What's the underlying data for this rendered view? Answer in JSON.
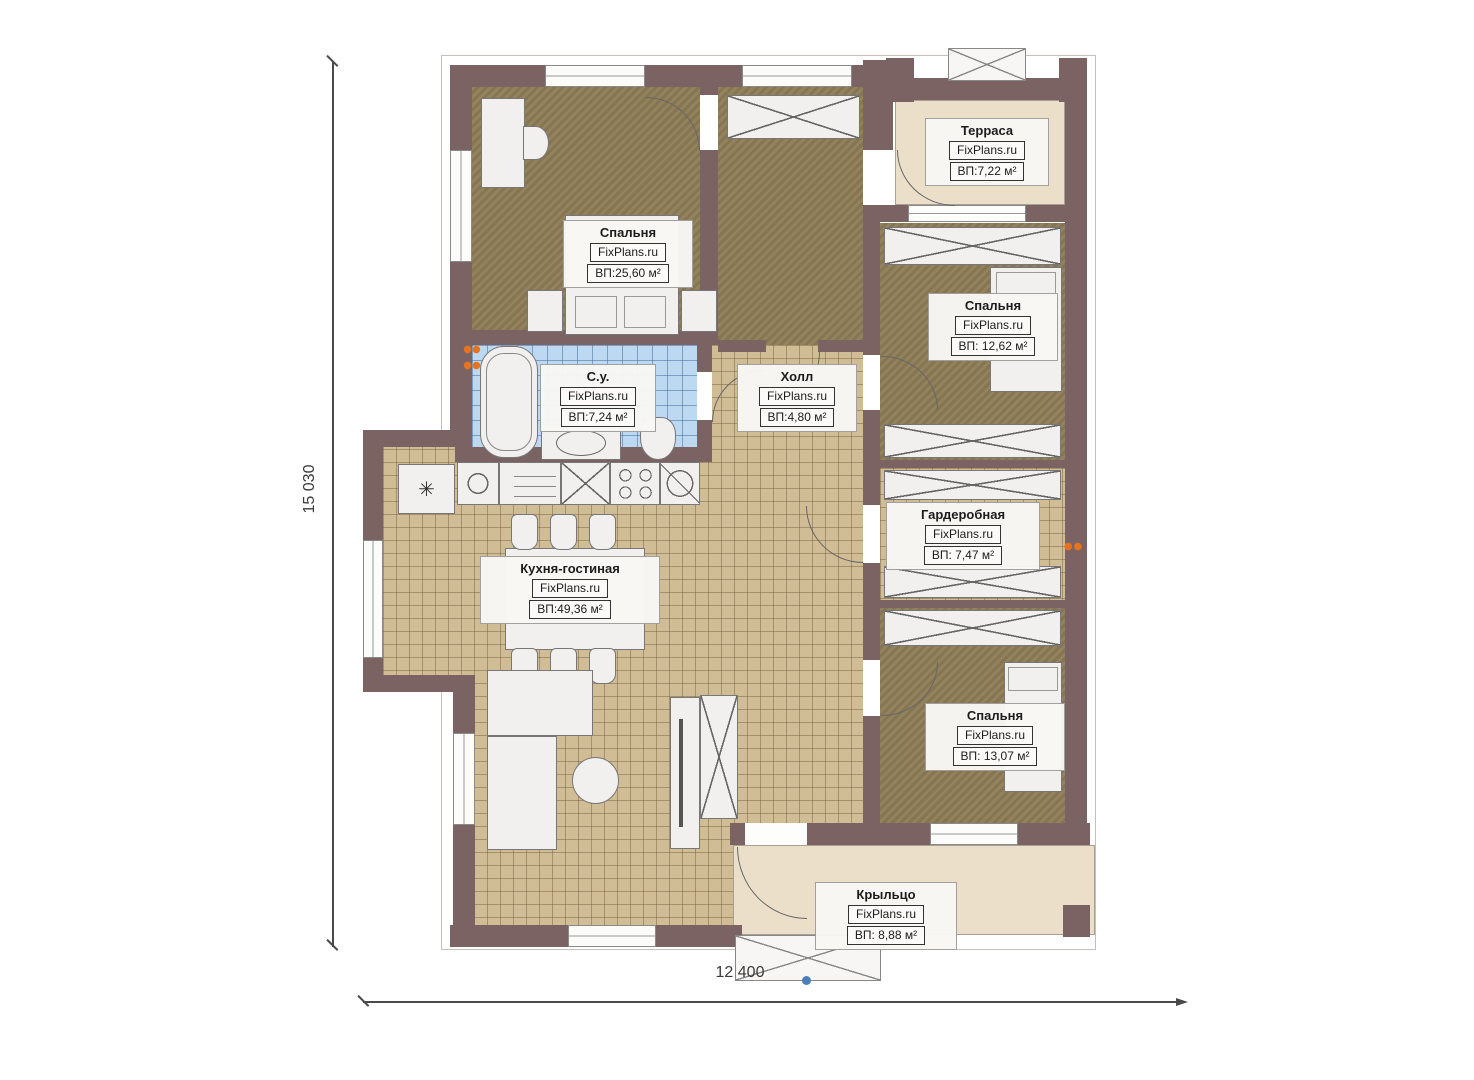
{
  "plan": {
    "brand": "FixPlans.ru",
    "dimensions": {
      "height_label": "15 030",
      "width_label": "12 400"
    },
    "rooms": [
      {
        "key": "bedroom-1",
        "name": "Спальня",
        "brand": "FixPlans.ru",
        "area": "ВП:25,60 м²"
      },
      {
        "key": "terrace",
        "name": "Терраса",
        "brand": "FixPlans.ru",
        "area": "ВП:7,22 м²"
      },
      {
        "key": "bedroom-2",
        "name": "Спальня",
        "brand": "FixPlans.ru",
        "area": "ВП: 12,62 м²"
      },
      {
        "key": "bathroom",
        "name": "С.у.",
        "brand": "FixPlans.ru",
        "area": "ВП:7,24 м²"
      },
      {
        "key": "hall",
        "name": "Холл",
        "brand": "FixPlans.ru",
        "area": "ВП:4,80 м²"
      },
      {
        "key": "wardrobe-room",
        "name": "Гардеробная",
        "brand": "FixPlans.ru",
        "area": "ВП: 7,47 м²"
      },
      {
        "key": "kitchen-living",
        "name": "Кухня-гостиная",
        "brand": "FixPlans.ru",
        "area": "ВП:49,36 м²"
      },
      {
        "key": "bedroom-3",
        "name": "Спальня",
        "brand": "FixPlans.ru",
        "area": "ВП: 13,07 м²"
      },
      {
        "key": "porch",
        "name": "Крыльцо",
        "brand": "FixPlans.ru",
        "area": "ВП: 8,88 м²"
      }
    ],
    "icons": {
      "freezer": "✳"
    },
    "colors": {
      "wall": "#7b6364",
      "floor-khaki": "#8d7b55",
      "floor-tan": "#d1bd95",
      "floor-blue": "#bdd9f1",
      "floor-cream": "#ecdfca",
      "radiator": "#e8731e"
    }
  }
}
